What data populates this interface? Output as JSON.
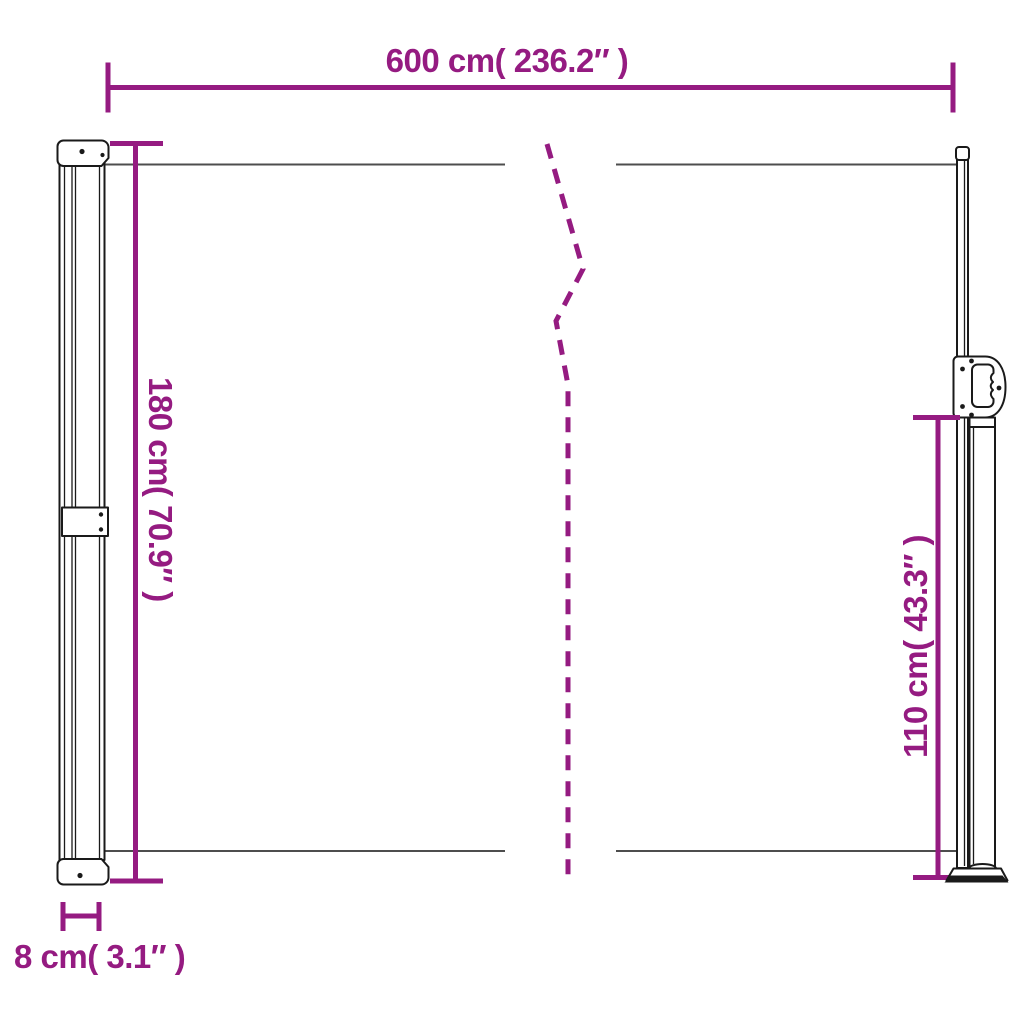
{
  "colors": {
    "dimension": "#951B81",
    "outline": "#1A1A1A",
    "fabric": "#4D4D4D",
    "background": "#FFFFFF"
  },
  "dimensions": {
    "top_width": {
      "label": "600 cm( 236.2″ )",
      "cm": 600,
      "inches": 236.2
    },
    "left_height": {
      "label": "180 cm( 70.9″ )",
      "cm": 180,
      "inches": 70.9
    },
    "right_height": {
      "label": "110 cm( 43.3″ )",
      "cm": 110,
      "inches": 43.3
    },
    "cassette_depth": {
      "label": "8 cm( 3.1″ )",
      "cm": 8,
      "inches": 3.1
    }
  }
}
